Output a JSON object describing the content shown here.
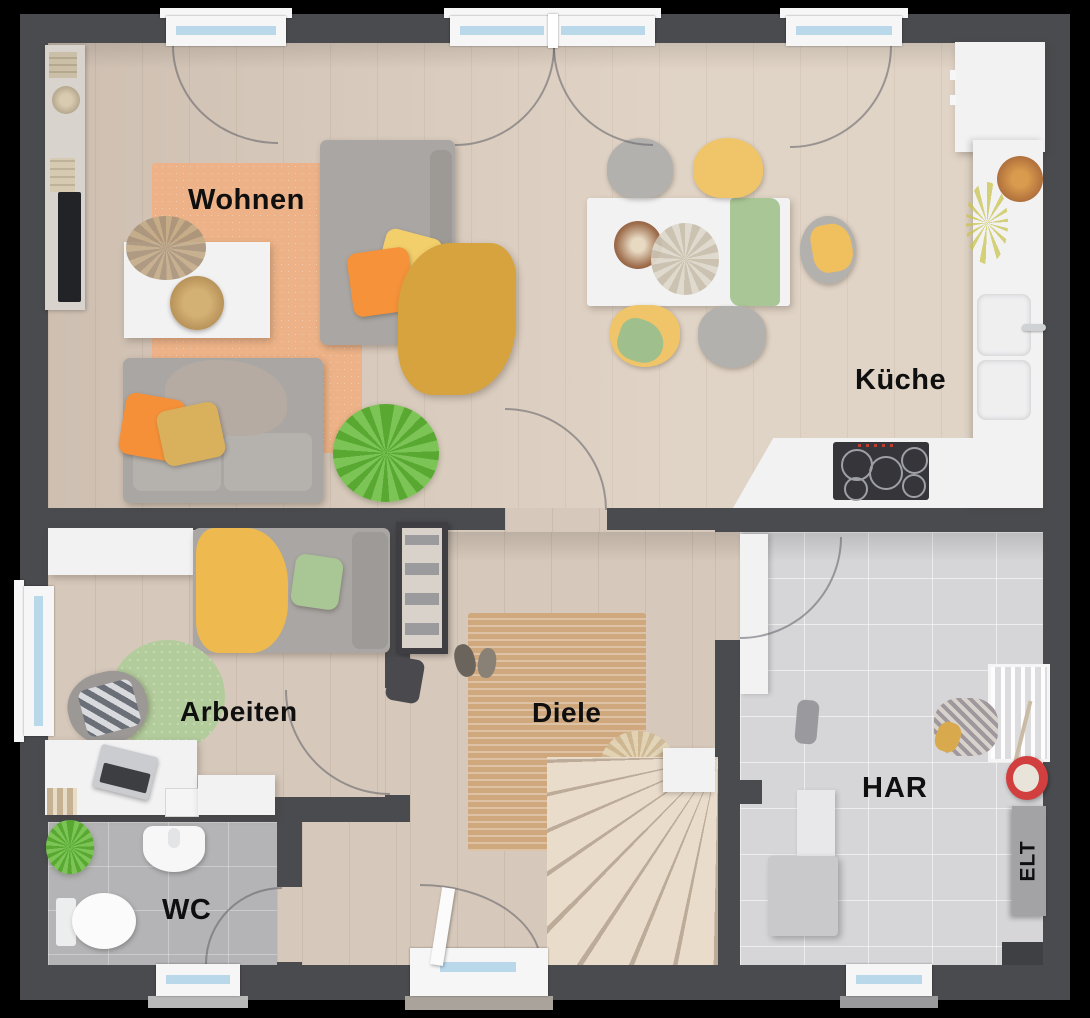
{
  "rooms": {
    "wohnen": {
      "label": "Wohnen"
    },
    "kueche": {
      "label": "Küche"
    },
    "arbeiten": {
      "label": "Arbeiten"
    },
    "diele": {
      "label": "Diele"
    },
    "wc": {
      "label": "WC"
    },
    "har": {
      "label": "HAR"
    }
  },
  "panel": {
    "elt_label": "ELT"
  },
  "colors": {
    "background": "#000000",
    "wall": "#4a4b4f",
    "wood_floor": "#d6c8ba",
    "tile_wc": "#b4b4b6",
    "tile_har": "#d6d6d8",
    "counter_white": "#f2f2f3",
    "window_glass": "#b9d9eb",
    "rug_orange": "#edb287",
    "rug_jute": "#cfa87e",
    "rug_green": "#b3cc9c",
    "accent_orange": "#f5923a",
    "accent_yellow": "#f0c469",
    "accent_mustard": "#d7a33f",
    "accent_green": "#a9c795",
    "bucket_red": "#d23f3f"
  }
}
